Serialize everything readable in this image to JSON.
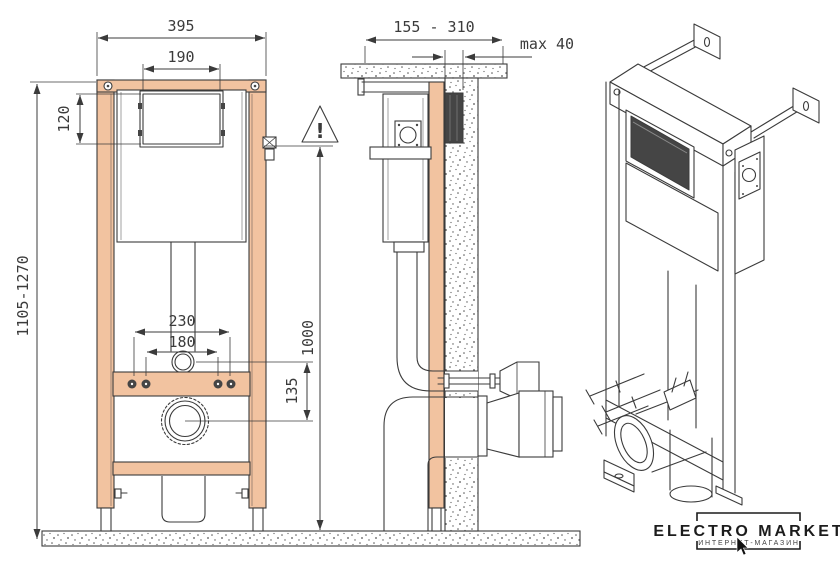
{
  "colors": {
    "bg": "#ffffff",
    "line": "#3b3b3b",
    "frame": "#f2c3a0",
    "dark": "#454545",
    "logo": "#1c1c1c"
  },
  "dims": {
    "frame_width": "395",
    "plate_window_width": "190",
    "plate_window_height": "120",
    "frame_height_range": "1105-1270",
    "fixing_spacing_outer": "230",
    "fixing_spacing_inner": "180",
    "outlet_drop": "135",
    "wall_depth_range": "155 - 310",
    "finish_max_thickness": "max 40",
    "flush_bend_height": "1000",
    "warning_mark": "!"
  },
  "logo": {
    "title": "ELECTRO MARKET",
    "subtitle": "ИНТЕРНЕТ-МАГАЗИН"
  }
}
